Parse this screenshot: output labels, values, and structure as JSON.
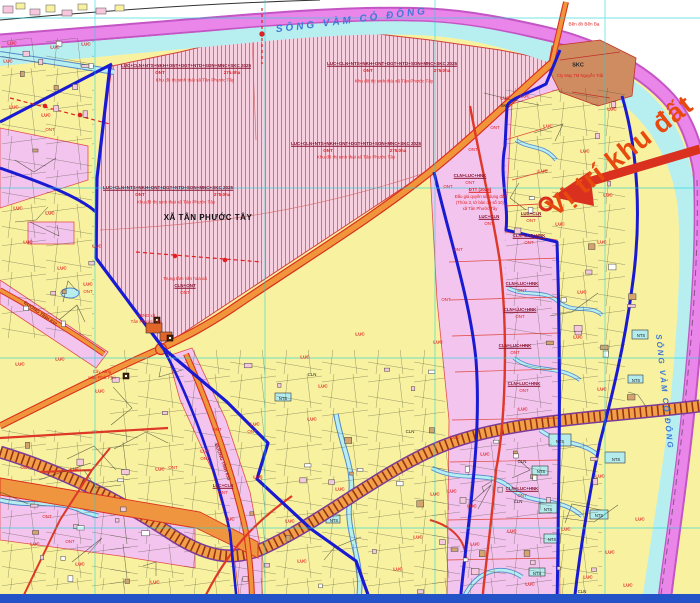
{
  "map": {
    "region_name": "XÃ TÂN PHƯỚC TÂY",
    "river_name": "SÔNG VÀM CỎ ĐÔNG",
    "highlight_note": "Vị trí khu đất",
    "planning_zone": {
      "codes": "LUC+CLN+NTS+NKH+ONT+DGT+NTD+SON+MNC+SKC 2025",
      "current_code": "ONT",
      "area": "275.0ha",
      "name": "Khu đô thị sinh thái xã Tân Phước Tây"
    },
    "roads": [
      "ĐƯỜNG TỈNH 832",
      "ĐƯỜNG TỈNH 833"
    ],
    "land_codes": [
      "LUC",
      "ONT",
      "CLN",
      "NTS",
      "SKC",
      "HNK",
      "DGT",
      "NTD",
      "SON",
      "MNC",
      "NKH"
    ],
    "pois": [
      "Trung tâm văn hóa xã",
      "UBND xã Tân Phước Tây",
      "Cây xăng Hào Phát Phú",
      "Bến đò Bến Bạ",
      "Cty May TM Nguyễn Trãi"
    ],
    "auction_note": [
      "ĐTT (2025)",
      "Đấu giá quyền sử dụng đất",
      "(Thửa 3, tờ bản đồ số 10)",
      "xã Tân Phước Tây"
    ]
  },
  "colors": {
    "land_yellow": "#f8f2a0",
    "zone_pink": "#f3c4ee",
    "hatch_pink": "#f7d0e0",
    "river_cyan": "#b7eff1",
    "far_bank_magenta": "#ea85ea",
    "boundary_blue": "#1a1ad2",
    "road_orange": "#f0953a",
    "road_red": "#dd3828",
    "highlight_red": "#e8490f",
    "skc_brown": "#cf8c61",
    "bottom_bar_blue": "#2353c6"
  },
  "labels": [
    {
      "t": "SÔNG VÀM CỎ ĐÔNG",
      "x": 352,
      "y": 21,
      "s": 10,
      "c": "#3f78d6",
      "b": 1,
      "i": 1,
      "r": -7,
      "ls": 3
    },
    {
      "t": "SÔNG VÀM CỎ ĐÔNG",
      "x": 664,
      "y": 392,
      "s": 8,
      "c": "#3f78d6",
      "b": 1,
      "i": 1,
      "r": 84,
      "ls": 2
    },
    {
      "t": "Vị trí khu đất",
      "x": 620,
      "y": 156,
      "s": 27,
      "c": "#e8490f",
      "b": 1,
      "r": -38,
      "ls": 1
    },
    {
      "t": "XÃ TÂN PHƯỚC TÂY",
      "x": 208,
      "y": 218,
      "s": 8,
      "c": "#101010",
      "b": 1,
      "ls": 0.5
    },
    {
      "t": "LUC+CLN+NTS+NKH+ONT+DGT+NTD+SON+MNC+SKC 2025",
      "x": 186,
      "y": 66,
      "s": 4.5,
      "c": "#8a1430",
      "b": 1,
      "u": 1
    },
    {
      "t": "ONT",
      "x": 160,
      "y": 73,
      "s": 4.5,
      "c": "#e02020",
      "b": 1
    },
    {
      "t": "275.0ha",
      "x": 232,
      "y": 73,
      "s": 4.5,
      "c": "#e02020",
      "b": 1
    },
    {
      "t": "Khu đô thị sinh thái xã Tân Phước Tây",
      "x": 195,
      "y": 81,
      "s": 4.6,
      "c": "#e02020"
    },
    {
      "t": "LUC+CLN+NTS+NKH+ONT+DGT+NTD+SON+MNC+SKC 2025",
      "x": 392,
      "y": 64,
      "s": 4.5,
      "c": "#8a1430",
      "b": 1,
      "u": 1
    },
    {
      "t": "ONT",
      "x": 368,
      "y": 71,
      "s": 4.5,
      "c": "#e02020",
      "b": 1
    },
    {
      "t": "275.0ha",
      "x": 442,
      "y": 71,
      "s": 4.5,
      "c": "#e02020",
      "b": 1
    },
    {
      "t": "Khu đô thị sinh thái xã Tân Phước Tây",
      "x": 394,
      "y": 82,
      "s": 4.6,
      "c": "#e02020"
    },
    {
      "t": "LUC+CLN+NTS+NKH+ONT+DGT+NTD+SON+MNC+SKC 2025",
      "x": 356,
      "y": 144,
      "s": 4.5,
      "c": "#8a1430",
      "b": 1,
      "u": 1
    },
    {
      "t": "ONT",
      "x": 328,
      "y": 151,
      "s": 4.5,
      "c": "#e02020",
      "b": 1
    },
    {
      "t": "275.0ha",
      "x": 398,
      "y": 151,
      "s": 4.5,
      "c": "#e02020",
      "b": 1
    },
    {
      "t": "Khu đô thị sinh thái xã Tân Phước Tây",
      "x": 356,
      "y": 158,
      "s": 4.6,
      "c": "#e02020"
    },
    {
      "t": "LUC+CLN+NTS+NKH+ONT+DGT+NTD+SON+MNC+SKC 2025",
      "x": 168,
      "y": 188,
      "s": 4.5,
      "c": "#8a1430",
      "b": 1,
      "u": 1
    },
    {
      "t": "ONT",
      "x": 140,
      "y": 195,
      "s": 4.5,
      "c": "#e02020",
      "b": 1
    },
    {
      "t": "275.0ha",
      "x": 222,
      "y": 195,
      "s": 4.5,
      "c": "#e02020",
      "b": 1
    },
    {
      "t": "Khu đô thị sinh thái xã Tân Phước Tây",
      "x": 176,
      "y": 203,
      "s": 4.6,
      "c": "#e02020"
    },
    {
      "t": "Trung tâm văn hóa xã",
      "x": 185,
      "y": 279,
      "s": 4.5,
      "c": "#e02020"
    },
    {
      "t": "CLN+ONT",
      "x": 185,
      "y": 286,
      "s": 4.5,
      "c": "#8a1430",
      "b": 1,
      "u": 1
    },
    {
      "t": "ONT",
      "x": 185,
      "y": 293,
      "s": 4.5,
      "c": "#e02020"
    },
    {
      "t": "UBND xã",
      "x": 146,
      "y": 316,
      "s": 4.4,
      "c": "#e02020"
    },
    {
      "t": "Tân Phước Tây",
      "x": 146,
      "y": 322,
      "s": 4.4,
      "c": "#e02020"
    },
    {
      "t": "Cây xăng",
      "x": 102,
      "y": 372,
      "s": 4.4,
      "c": "#e02020"
    },
    {
      "t": "Hào Phát Phú",
      "x": 102,
      "y": 378,
      "s": 4.4,
      "c": "#e02020"
    },
    {
      "t": "Bến đò Bến Bạ",
      "x": 584,
      "y": 25,
      "s": 4.6,
      "c": "#e02020"
    },
    {
      "t": "SKC",
      "x": 578,
      "y": 66,
      "s": 5.5,
      "c": "#222222",
      "b": 1
    },
    {
      "t": "Cty May TM Nguyễn Trãi",
      "x": 580,
      "y": 76,
      "s": 4.2,
      "c": "#e02020"
    },
    {
      "t": "ĐƯỜNG TỈNH 832",
      "x": 40,
      "y": 314,
      "s": 4.6,
      "c": "#a02020",
      "b": 1,
      "r": 35
    },
    {
      "t": "ĐƯỜNG TỈNH 833",
      "x": 222,
      "y": 462,
      "s": 4.6,
      "c": "#a02020",
      "b": 1,
      "r": 70
    },
    {
      "t": "ĐTT (2025)",
      "x": 480,
      "y": 190,
      "s": 4.4,
      "c": "#e02020",
      "b": 1,
      "u": 1
    },
    {
      "t": "Đấu giá quyền sử dụng đất",
      "x": 480,
      "y": 197,
      "s": 4.2,
      "c": "#e02020"
    },
    {
      "t": "(Thửa 3, tờ bản đồ số 10)",
      "x": 480,
      "y": 203,
      "s": 4.2,
      "c": "#e02020"
    },
    {
      "t": "xã Tân Phước Tây",
      "x": 480,
      "y": 209,
      "s": 4.2,
      "c": "#e02020"
    },
    {
      "t": "CLN+LUC+HNK",
      "x": 470,
      "y": 176,
      "s": 4.4,
      "c": "#8a1430",
      "b": 1,
      "u": 1
    },
    {
      "t": "ONT",
      "x": 470,
      "y": 183,
      "s": 4.4,
      "c": "#e02020"
    },
    {
      "t": "LUC+CLN",
      "x": 489,
      "y": 217,
      "s": 4.4,
      "c": "#8a1430",
      "b": 1,
      "u": 1
    },
    {
      "t": "ONT",
      "x": 489,
      "y": 224,
      "s": 4.4,
      "c": "#e02020"
    },
    {
      "t": "LUC+CLN",
      "x": 531,
      "y": 214,
      "s": 4.4,
      "c": "#8a1430",
      "b": 1,
      "u": 1
    },
    {
      "t": "ONT",
      "x": 531,
      "y": 221,
      "s": 4.4,
      "c": "#e02020"
    },
    {
      "t": "CLN+LUC+HNK",
      "x": 529,
      "y": 236,
      "s": 4.4,
      "c": "#8a1430",
      "b": 1,
      "u": 1
    },
    {
      "t": "ONT",
      "x": 529,
      "y": 243,
      "s": 4.4,
      "c": "#e02020"
    },
    {
      "t": "CLN+LUC+HNK",
      "x": 522,
      "y": 284,
      "s": 4.4,
      "c": "#8a1430",
      "b": 1,
      "u": 1
    },
    {
      "t": "ONT",
      "x": 522,
      "y": 291,
      "s": 4.4,
      "c": "#e02020"
    },
    {
      "t": "CLN+LUC+HNK",
      "x": 520,
      "y": 310,
      "s": 4.4,
      "c": "#8a1430",
      "b": 1,
      "u": 1
    },
    {
      "t": "ONT",
      "x": 520,
      "y": 317,
      "s": 4.4,
      "c": "#e02020"
    },
    {
      "t": "CLN+LUC+HNK",
      "x": 515,
      "y": 346,
      "s": 4.4,
      "c": "#8a1430",
      "b": 1,
      "u": 1
    },
    {
      "t": "ONT",
      "x": 515,
      "y": 353,
      "s": 4.4,
      "c": "#e02020"
    },
    {
      "t": "CLN+LUC+HNK",
      "x": 524,
      "y": 384,
      "s": 4.4,
      "c": "#8a1430",
      "b": 1,
      "u": 1
    },
    {
      "t": "ONT",
      "x": 524,
      "y": 391,
      "s": 4.4,
      "c": "#e02020"
    },
    {
      "t": "CLN+LUC+HNK",
      "x": 522,
      "y": 489,
      "s": 4.4,
      "c": "#8a1430",
      "b": 1,
      "u": 1
    },
    {
      "t": "ONT",
      "x": 522,
      "y": 496,
      "s": 4.4,
      "c": "#e02020"
    },
    {
      "t": "LUC+CLN",
      "x": 223,
      "y": 486,
      "s": 4.4,
      "c": "#8a1430",
      "b": 1,
      "u": 1
    },
    {
      "t": "ONT",
      "x": 223,
      "y": 493,
      "s": 4.4,
      "c": "#e02020"
    },
    {
      "t": "LUC",
      "x": 12,
      "y": 44,
      "s": 4.6,
      "c": "#e02020",
      "b": 1
    },
    {
      "t": "LUC",
      "x": 55,
      "y": 48,
      "s": 4.6,
      "c": "#e02020",
      "b": 1
    },
    {
      "t": "LUC",
      "x": 86,
      "y": 45,
      "s": 4.6,
      "c": "#e02020",
      "b": 1
    },
    {
      "t": "LUC",
      "x": 8,
      "y": 62,
      "s": 4.6,
      "c": "#e02020",
      "b": 1
    },
    {
      "t": "LUC",
      "x": 14,
      "y": 108,
      "s": 4.6,
      "c": "#e02020",
      "b": 1
    },
    {
      "t": "LUC",
      "x": 46,
      "y": 116,
      "s": 4.6,
      "c": "#e02020",
      "b": 1
    },
    {
      "t": "LUC",
      "x": 18,
      "y": 209,
      "s": 4.6,
      "c": "#e02020",
      "b": 1
    },
    {
      "t": "LUC",
      "x": 50,
      "y": 214,
      "s": 4.6,
      "c": "#e02020",
      "b": 1
    },
    {
      "t": "LUC",
      "x": 28,
      "y": 243,
      "s": 4.6,
      "c": "#e02020",
      "b": 1
    },
    {
      "t": "LUC",
      "x": 97,
      "y": 247,
      "s": 4.6,
      "c": "#e02020",
      "b": 1
    },
    {
      "t": "LUC",
      "x": 62,
      "y": 269,
      "s": 4.6,
      "c": "#e02020",
      "b": 1
    },
    {
      "t": "LUC",
      "x": 88,
      "y": 285,
      "s": 4.6,
      "c": "#e02020",
      "b": 1
    },
    {
      "t": "LUC",
      "x": 20,
      "y": 365,
      "s": 4.6,
      "c": "#e02020",
      "b": 1
    },
    {
      "t": "LUC",
      "x": 60,
      "y": 360,
      "s": 4.6,
      "c": "#e02020",
      "b": 1
    },
    {
      "t": "LUC",
      "x": 100,
      "y": 392,
      "s": 4.6,
      "c": "#e02020",
      "b": 1
    },
    {
      "t": "LUC",
      "x": 75,
      "y": 470,
      "s": 4.6,
      "c": "#e02020",
      "b": 1
    },
    {
      "t": "LUC",
      "x": 160,
      "y": 470,
      "s": 4.6,
      "c": "#e02020",
      "b": 1
    },
    {
      "t": "LUC",
      "x": 35,
      "y": 545,
      "s": 4.6,
      "c": "#e02020",
      "b": 1
    },
    {
      "t": "LUC",
      "x": 80,
      "y": 565,
      "s": 4.6,
      "c": "#e02020",
      "b": 1
    },
    {
      "t": "LUC",
      "x": 155,
      "y": 583,
      "s": 4.6,
      "c": "#e02020",
      "b": 1
    },
    {
      "t": "LUC",
      "x": 205,
      "y": 452,
      "s": 4.6,
      "c": "#e02020",
      "b": 1
    },
    {
      "t": "LUC",
      "x": 255,
      "y": 425,
      "s": 4.6,
      "c": "#e02020",
      "b": 1
    },
    {
      "t": "LUC",
      "x": 312,
      "y": 420,
      "s": 4.6,
      "c": "#e02020",
      "b": 1
    },
    {
      "t": "LUC",
      "x": 360,
      "y": 335,
      "s": 4.6,
      "c": "#e02020",
      "b": 1
    },
    {
      "t": "LUC",
      "x": 305,
      "y": 358,
      "s": 4.6,
      "c": "#e02020",
      "b": 1
    },
    {
      "t": "LUC",
      "x": 323,
      "y": 387,
      "s": 4.6,
      "c": "#e02020",
      "b": 1
    },
    {
      "t": "LUC",
      "x": 438,
      "y": 343,
      "s": 4.6,
      "c": "#e02020",
      "b": 1
    },
    {
      "t": "LUC",
      "x": 230,
      "y": 520,
      "s": 4.6,
      "c": "#e02020",
      "b": 1
    },
    {
      "t": "LUC",
      "x": 290,
      "y": 522,
      "s": 4.6,
      "c": "#e02020",
      "b": 1
    },
    {
      "t": "LUC",
      "x": 340,
      "y": 490,
      "s": 4.6,
      "c": "#e02020",
      "b": 1
    },
    {
      "t": "LUC",
      "x": 302,
      "y": 562,
      "s": 4.6,
      "c": "#e02020",
      "b": 1
    },
    {
      "t": "LUC",
      "x": 398,
      "y": 570,
      "s": 4.6,
      "c": "#e02020",
      "b": 1
    },
    {
      "t": "LUC",
      "x": 418,
      "y": 538,
      "s": 4.6,
      "c": "#e02020",
      "b": 1
    },
    {
      "t": "LUC",
      "x": 258,
      "y": 478,
      "s": 4.6,
      "c": "#e02020",
      "b": 1
    },
    {
      "t": "LUC",
      "x": 525,
      "y": 97,
      "s": 4.6,
      "c": "#e02020",
      "b": 1
    },
    {
      "t": "LUC",
      "x": 548,
      "y": 127,
      "s": 4.6,
      "c": "#e02020",
      "b": 1
    },
    {
      "t": "LUC",
      "x": 543,
      "y": 172,
      "s": 4.6,
      "c": "#e02020",
      "b": 1
    },
    {
      "t": "LUC",
      "x": 585,
      "y": 152,
      "s": 4.6,
      "c": "#e02020",
      "b": 1
    },
    {
      "t": "LUC",
      "x": 602,
      "y": 243,
      "s": 4.6,
      "c": "#e02020",
      "b": 1
    },
    {
      "t": "LUC",
      "x": 560,
      "y": 225,
      "s": 4.6,
      "c": "#e02020",
      "b": 1
    },
    {
      "t": "LUC",
      "x": 582,
      "y": 293,
      "s": 4.6,
      "c": "#e02020",
      "b": 1
    },
    {
      "t": "LUC",
      "x": 578,
      "y": 338,
      "s": 4.6,
      "c": "#e02020",
      "b": 1
    },
    {
      "t": "LUC",
      "x": 608,
      "y": 196,
      "s": 4.6,
      "c": "#e02020",
      "b": 1
    },
    {
      "t": "LUC",
      "x": 602,
      "y": 390,
      "s": 4.6,
      "c": "#e02020",
      "b": 1
    },
    {
      "t": "LUC",
      "x": 612,
      "y": 110,
      "s": 4.6,
      "c": "#e02020",
      "b": 1
    },
    {
      "t": "LUC",
      "x": 485,
      "y": 455,
      "s": 4.6,
      "c": "#e02020",
      "b": 1
    },
    {
      "t": "LUC",
      "x": 452,
      "y": 492,
      "s": 4.6,
      "c": "#e02020",
      "b": 1
    },
    {
      "t": "LUC",
      "x": 472,
      "y": 507,
      "s": 4.6,
      "c": "#e02020",
      "b": 1
    },
    {
      "t": "LUC",
      "x": 512,
      "y": 532,
      "s": 4.6,
      "c": "#e02020",
      "b": 1
    },
    {
      "t": "LUC",
      "x": 566,
      "y": 530,
      "s": 4.6,
      "c": "#e02020",
      "b": 1
    },
    {
      "t": "LUC",
      "x": 610,
      "y": 553,
      "s": 4.6,
      "c": "#e02020",
      "b": 1
    },
    {
      "t": "LUC",
      "x": 640,
      "y": 520,
      "s": 4.6,
      "c": "#e02020",
      "b": 1
    },
    {
      "t": "LUC",
      "x": 588,
      "y": 578,
      "s": 4.6,
      "c": "#e02020",
      "b": 1
    },
    {
      "t": "LUC",
      "x": 628,
      "y": 586,
      "s": 4.6,
      "c": "#e02020",
      "b": 1
    },
    {
      "t": "LUC",
      "x": 530,
      "y": 585,
      "s": 4.6,
      "c": "#e02020",
      "b": 1
    },
    {
      "t": "LUC",
      "x": 475,
      "y": 545,
      "s": 4.6,
      "c": "#e02020",
      "b": 1
    },
    {
      "t": "LUC",
      "x": 435,
      "y": 495,
      "s": 4.6,
      "c": "#e02020",
      "b": 1
    },
    {
      "t": "LUC",
      "x": 523,
      "y": 410,
      "s": 4.6,
      "c": "#e02020",
      "b": 1
    },
    {
      "t": "LUC",
      "x": 455,
      "y": 438,
      "s": 4.6,
      "c": "#e02020",
      "b": 1
    },
    {
      "t": "LUC",
      "x": 600,
      "y": 477,
      "s": 4.6,
      "c": "#e02020",
      "b": 1
    },
    {
      "t": "LUC",
      "x": 505,
      "y": 99,
      "s": 4.6,
      "c": "#e02020",
      "b": 1
    },
    {
      "t": "ONT",
      "x": 50,
      "y": 130,
      "s": 4.4,
      "c": "#e02020"
    },
    {
      "t": "ONT",
      "x": 88,
      "y": 292,
      "s": 4.4,
      "c": "#e02020"
    },
    {
      "t": "ONT",
      "x": 25,
      "y": 468,
      "s": 4.4,
      "c": "#e02020"
    },
    {
      "t": "ONT",
      "x": 47,
      "y": 517,
      "s": 4.4,
      "c": "#e02020"
    },
    {
      "t": "ONT",
      "x": 173,
      "y": 468,
      "s": 4.4,
      "c": "#e02020"
    },
    {
      "t": "ONT",
      "x": 217,
      "y": 430,
      "s": 4.4,
      "c": "#e02020"
    },
    {
      "t": "ONT",
      "x": 252,
      "y": 432,
      "s": 4.4,
      "c": "#e02020"
    },
    {
      "t": "ONT",
      "x": 70,
      "y": 542,
      "s": 4.4,
      "c": "#e02020"
    },
    {
      "t": "ONT",
      "x": 495,
      "y": 128,
      "s": 4.4,
      "c": "#e02020"
    },
    {
      "t": "ONT",
      "x": 473,
      "y": 150,
      "s": 4.4,
      "c": "#e02020"
    },
    {
      "t": "ONT",
      "x": 448,
      "y": 187,
      "s": 4.4,
      "c": "#e02020"
    },
    {
      "t": "ONT",
      "x": 205,
      "y": 459,
      "s": 4.4,
      "c": "#e02020"
    },
    {
      "t": "ONT",
      "x": 458,
      "y": 250,
      "s": 4.4,
      "c": "#e02020"
    },
    {
      "t": "ONT",
      "x": 446,
      "y": 300,
      "s": 4.4,
      "c": "#e02020"
    },
    {
      "t": "CLN",
      "x": 522,
      "y": 462,
      "s": 4.4,
      "c": "#1a1a1a"
    },
    {
      "t": "CLN",
      "x": 518,
      "y": 502,
      "s": 4.4,
      "c": "#1a1a1a"
    },
    {
      "t": "CLN",
      "x": 312,
      "y": 375,
      "s": 4.4,
      "c": "#1a1a1a"
    },
    {
      "t": "CLN",
      "x": 410,
      "y": 432,
      "s": 4.4,
      "c": "#1a1a1a"
    },
    {
      "t": "CLN",
      "x": 582,
      "y": 592,
      "s": 4.4,
      "c": "#1a1a1a"
    },
    {
      "t": "NTS",
      "x": 560,
      "y": 442,
      "s": 4.2,
      "c": "#1a1a1a"
    },
    {
      "t": "NTS",
      "x": 616,
      "y": 460,
      "s": 4.2,
      "c": "#1a1a1a"
    },
    {
      "t": "NTS",
      "x": 541,
      "y": 472,
      "s": 4.2,
      "c": "#1a1a1a"
    },
    {
      "t": "NTS",
      "x": 548,
      "y": 510,
      "s": 4.2,
      "c": "#1a1a1a"
    },
    {
      "t": "NTS",
      "x": 599,
      "y": 516,
      "s": 4.2,
      "c": "#1a1a1a"
    },
    {
      "t": "NTS",
      "x": 552,
      "y": 540,
      "s": 4.2,
      "c": "#1a1a1a"
    },
    {
      "t": "NTS",
      "x": 537,
      "y": 574,
      "s": 4.2,
      "c": "#1a1a1a"
    },
    {
      "t": "NTS",
      "x": 641,
      "y": 336,
      "s": 4.2,
      "c": "#1a1a1a"
    },
    {
      "t": "NTS",
      "x": 636,
      "y": 381,
      "s": 4.2,
      "c": "#1a1a1a"
    },
    {
      "t": "NTS",
      "x": 283,
      "y": 399,
      "s": 4.2,
      "c": "#1a1a1a"
    },
    {
      "t": "NTS",
      "x": 334,
      "y": 521,
      "s": 4.2,
      "c": "#1a1a1a"
    },
    {
      "t": "SKC",
      "x": 505,
      "y": 106,
      "s": 4.4,
      "c": "#1a1a1a"
    }
  ]
}
